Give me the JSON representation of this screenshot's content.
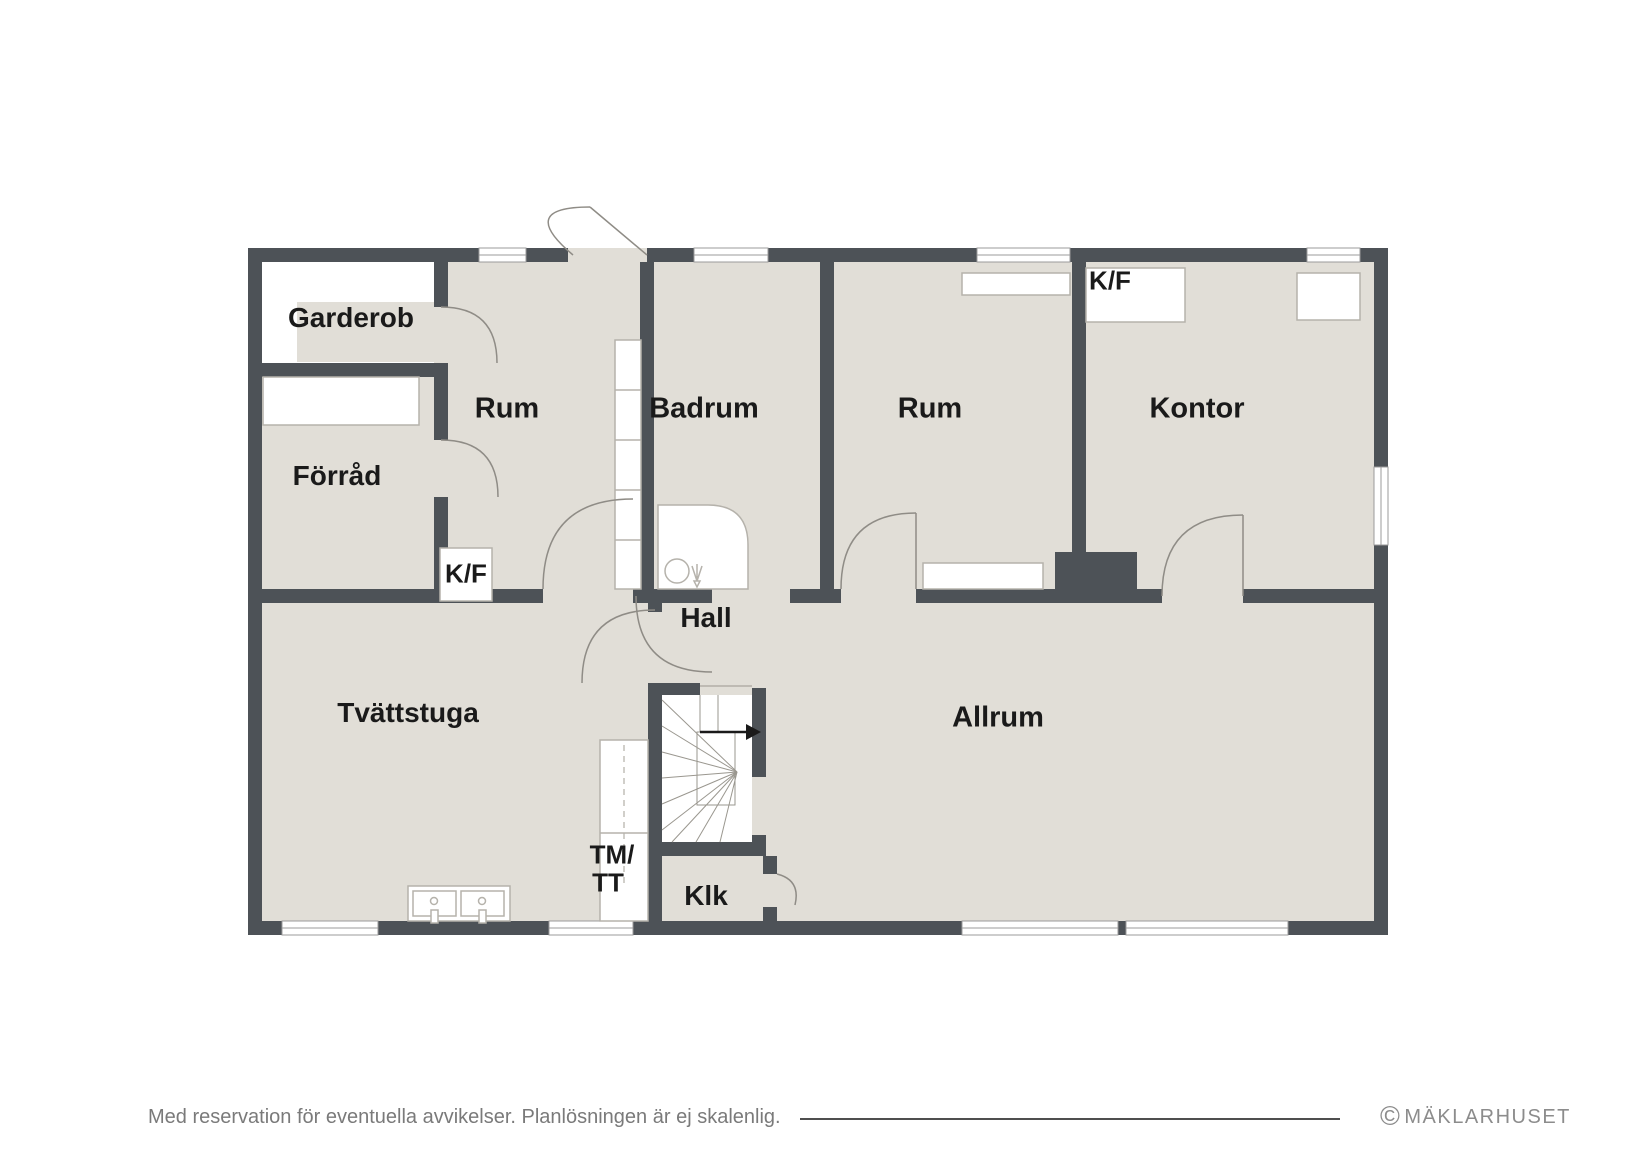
{
  "labels": {
    "garderob": "Garderob",
    "forrad": "Förråd",
    "rum1": "Rum",
    "badrum": "Badrum",
    "rum2": "Rum",
    "kontor": "Kontor",
    "kf_kontor": "K/F",
    "kf_rum": "K/F",
    "hall": "Hall",
    "tvattstuga": "Tvättstuga",
    "allrum": "Allrum",
    "klk": "Klk",
    "tm_line1": "TM/",
    "tm_line2": "TT"
  },
  "footer": {
    "disclaimer": "Med reservation för eventuella avvikelser. Planlösningen är ej skalenlig.",
    "copyright": "©",
    "brand": "MÄKLARHUSET"
  },
  "colors": {
    "wall": "#4d5257",
    "floor": "#e1ded7",
    "fixture_outline": "#b5b2ab",
    "window_outline": "#9b9b9b",
    "door_arc": "#8f8c86",
    "label_text": "#1a1a1a",
    "footer_text": "#7a7a7a",
    "brand_text": "#8c8c8c"
  }
}
